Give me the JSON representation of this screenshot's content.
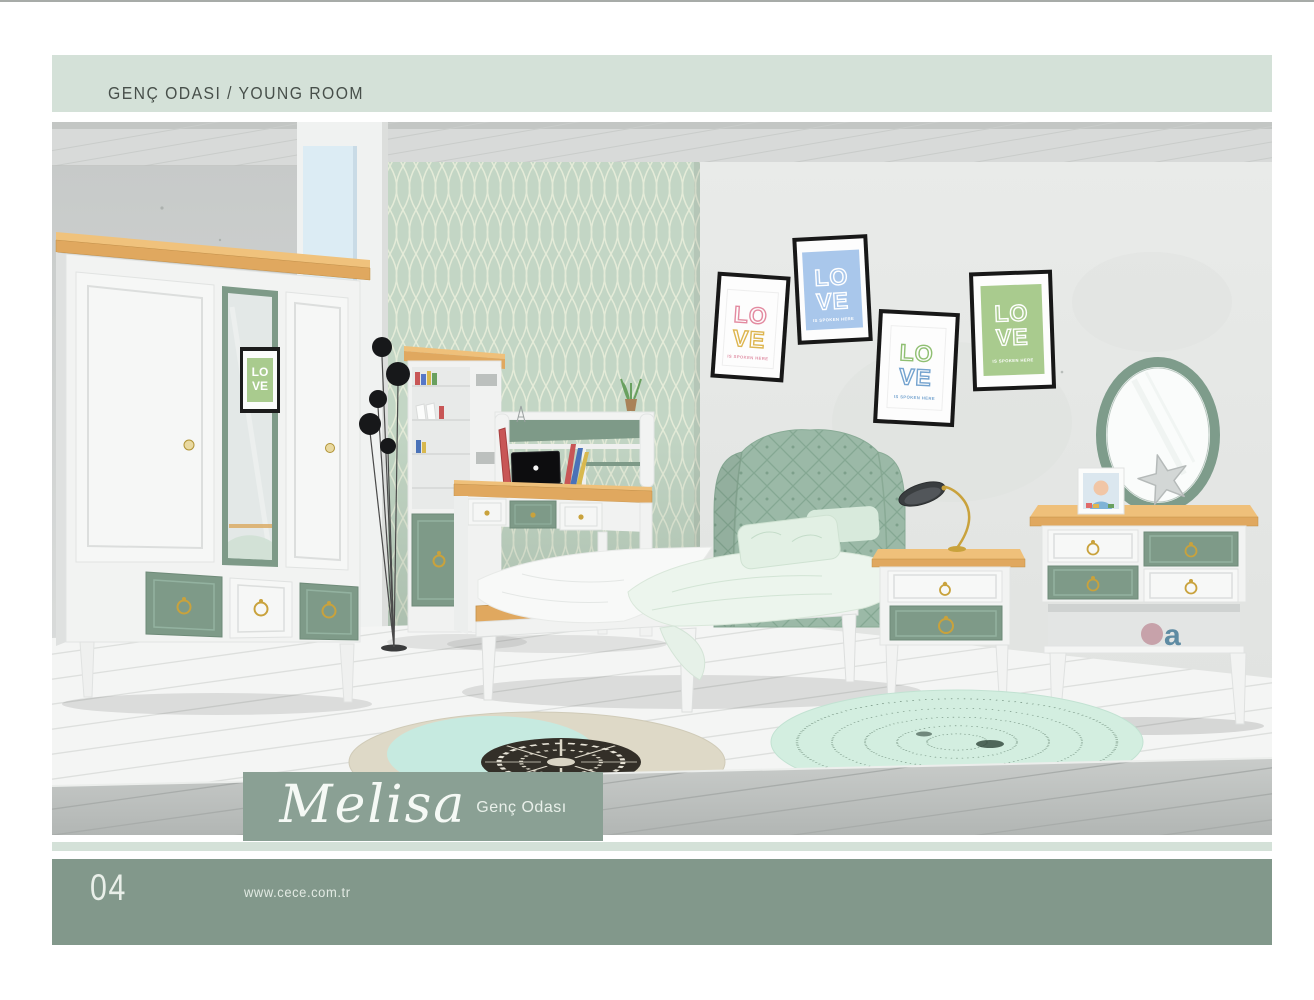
{
  "header": {
    "title": "GENÇ ODASI / YOUNG ROOM"
  },
  "brand": {
    "title": "Melisa",
    "subtitle": "Genç Odası"
  },
  "footer": {
    "page_number": "04",
    "website": "www.cece.com.tr"
  },
  "colors": {
    "header_bg": "#d4e1d8",
    "strip_bg": "#d4e1d8",
    "footer_bg": "#82988b",
    "band_bg": "#8aa094",
    "accent_sage": "#7e9a88",
    "headboard_green": "#9bb9a7",
    "wallpaper_green": "#c3d6c5",
    "wood": "#e0a85f",
    "gold": "#c9a23c",
    "poster_frame": "#181818"
  },
  "scene": {
    "posters": [
      {
        "name": "pink",
        "line1": "LO",
        "line2": "VE",
        "caption": "IS SPOKEN HERE",
        "bg": "#fdfdfd",
        "color1": "#e38aa0",
        "color2": "#ddb54f"
      },
      {
        "name": "blue",
        "line1": "LO",
        "line2": "VE",
        "caption": "IS SPOKEN HERE",
        "bg": "#a9c7eb",
        "color1": "#ffffff",
        "color2": "#ffffff"
      },
      {
        "name": "green-blue",
        "line1": "LO",
        "line2": "VE",
        "caption": "IS SPOKEN HERE",
        "bg": "#fdfdfd",
        "color1": "#8fbf72",
        "color2": "#74a3cf"
      },
      {
        "name": "green",
        "line1": "LO",
        "line2": "VE",
        "caption": "IS SPOKEN HERE",
        "bg": "#a9cb8e",
        "color1": "#ffffff",
        "color2": "#ffffff"
      }
    ],
    "mirror_poster": {
      "line1": "LO",
      "line2": "VE"
    },
    "decor": {
      "letter": "a"
    }
  }
}
